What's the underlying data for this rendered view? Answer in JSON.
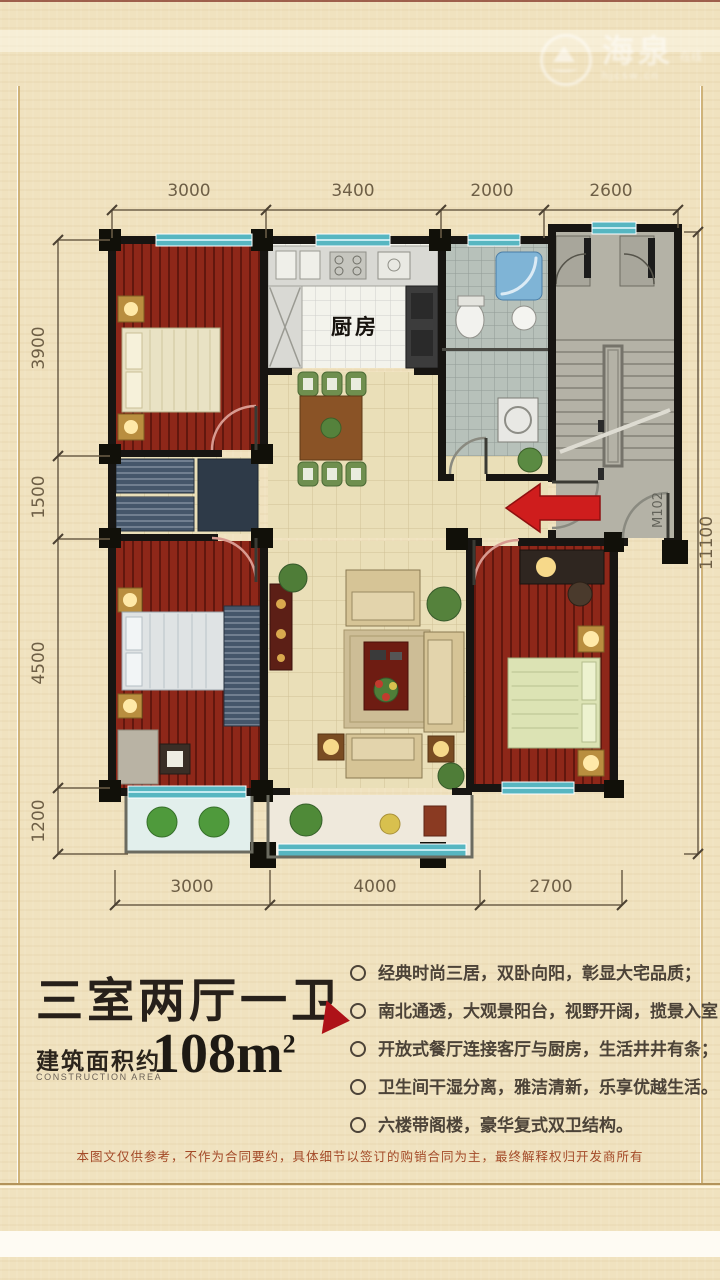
{
  "watermark": {
    "brand": "海泉",
    "tag": "在线",
    "sub": "hjcsw.cn"
  },
  "plan": {
    "dims_top": [
      "3000",
      "3400",
      "2000",
      "2600"
    ],
    "dims_left": [
      "3900",
      "1500",
      "4500",
      "1200"
    ],
    "dims_bottom": [
      "3000",
      "4000",
      "2700"
    ],
    "dim_right": "11100",
    "kitchen_label": "厨房",
    "door_label": "M102"
  },
  "info": {
    "title": "三室两厅一卫",
    "area_prefix": "建筑面积约",
    "area_prefix_en": "CONSTRUCTION AREA",
    "area_value": "108m",
    "area_sup": "2",
    "features": [
      "经典时尚三居，双卧向阳，彰显大宅品质；",
      "南北通透，大观景阳台，视野开阔，揽景入室；",
      "开放式餐厅连接客厅与厨房，生活井井有条；",
      "卫生间干湿分离，雅洁清新，乐享优越生活。",
      "六楼带阁楼，豪华复式双卫结构。"
    ],
    "disclaimer": "本图文仅供参考，不作为合同要约，具体细节以签订的购销合同为主，最终解释权归开发商所有"
  },
  "colors": {
    "accent_red": "#ae1218",
    "wall_black": "#171512",
    "window_teal": "#57b6c1",
    "bedroom_floor": "#8e2719",
    "background": "#f0e2bf",
    "disclaimer_text": "#a34a28"
  }
}
